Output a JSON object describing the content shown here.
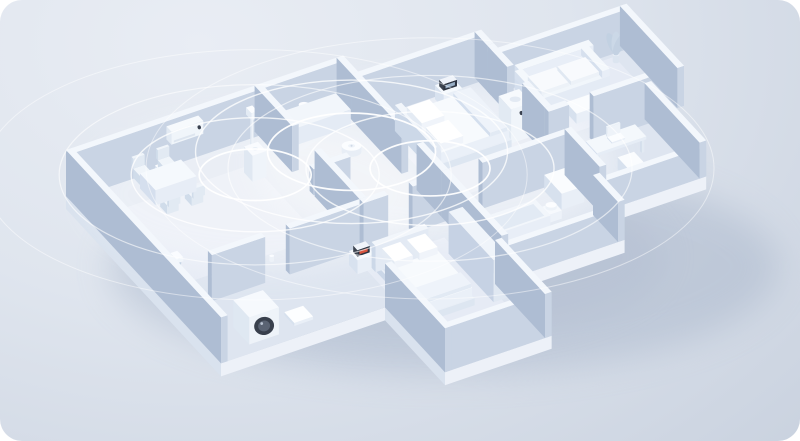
{
  "canvas": {
    "width": 800,
    "height": 441,
    "corner_radius": 22
  },
  "palette": {
    "background_top": "#e9edf4",
    "background_mid": "#dfe5ee",
    "background_bottom": "#c5cedc",
    "wall_top": "#f3f7fc",
    "wall_face_light": "#c9d4e4",
    "wall_face_dark": "#aebdd3",
    "floor": "#dee5f0",
    "slab_side_light": "#edf1f8",
    "slab_side_dark": "#d9e2ee",
    "rug": "#e9eef7",
    "object_top": "#fafcfe",
    "object_face_light": "#e9eff7",
    "object_face_dark": "#d7e1ee",
    "accent_dark": "#39404e",
    "signal_ring": "#ffffff",
    "shadow": "#9fadc4",
    "clock_display_red": "#e2563f",
    "clock_display_cool": "#9fb6cd"
  },
  "projection": {
    "origin": [
      66,
      196
    ],
    "u": [
      41,
      -14
    ],
    "v": [
      25,
      27
    ],
    "unit": 33
  },
  "floorplan": {
    "wall_height": 46,
    "wall_thickness": 0.16,
    "slab_drop": 13,
    "outline": [
      [
        0,
        0
      ],
      [
        6.6,
        0
      ],
      [
        6.6,
        0.6
      ],
      [
        9.6,
        0.6
      ],
      [
        9.6,
        1.1
      ],
      [
        13,
        1.1
      ],
      [
        13,
        3.4
      ],
      [
        12.2,
        3.4
      ],
      [
        12.2,
        5.6
      ],
      [
        9.6,
        5.6
      ],
      [
        9.6,
        6.6
      ],
      [
        6.6,
        6.6
      ],
      [
        6.6,
        8.6
      ],
      [
        4.0,
        8.6
      ],
      [
        4.0,
        6.2
      ],
      [
        0,
        6.2
      ]
    ],
    "walls": [
      {
        "f": [
          0,
          0
        ],
        "t": [
          6.6,
          0
        ]
      },
      {
        "f": [
          6.6,
          0
        ],
        "t": [
          6.6,
          0.6
        ]
      },
      {
        "f": [
          6.6,
          0.6
        ],
        "t": [
          9.6,
          0.6
        ]
      },
      {
        "f": [
          9.6,
          0.6
        ],
        "t": [
          9.6,
          1.1
        ]
      },
      {
        "f": [
          9.6,
          1.1
        ],
        "t": [
          13,
          1.1
        ],
        "h": 40
      },
      {
        "f": [
          12.84,
          1.1
        ],
        "t": [
          12.84,
          3.4
        ],
        "h": 40
      },
      {
        "f": [
          12.2,
          3.24
        ],
        "t": [
          13,
          3.24
        ],
        "h": 40
      },
      {
        "f": [
          12.04,
          3.4
        ],
        "t": [
          12.04,
          5.6
        ],
        "h": 36
      },
      {
        "f": [
          9.6,
          5.44
        ],
        "t": [
          12.2,
          5.44
        ],
        "h": 30
      },
      {
        "f": [
          9.44,
          5.6
        ],
        "t": [
          9.44,
          6.6
        ],
        "h": 40
      },
      {
        "f": [
          6.6,
          6.44
        ],
        "t": [
          9.6,
          6.44
        ],
        "h": 34
      },
      {
        "f": [
          6.44,
          6.6
        ],
        "t": [
          6.44,
          8.6
        ],
        "h": 44
      },
      {
        "f": [
          4.0,
          8.44
        ],
        "t": [
          6.6,
          8.44
        ],
        "h": 44
      },
      {
        "f": [
          4.0,
          6.2
        ],
        "t": [
          4.0,
          8.6
        ],
        "h": 44
      },
      {
        "f": [
          0,
          0
        ],
        "t": [
          0,
          6.2
        ]
      },
      {
        "f": [
          4.6,
          0
        ],
        "t": [
          4.6,
          1.5
        ]
      },
      {
        "f": [
          4.6,
          2.4
        ],
        "t": [
          4.6,
          4.2
        ]
      },
      {
        "f": [
          0.9,
          4.2
        ],
        "t": [
          2.2,
          4.2
        ]
      },
      {
        "f": [
          2.8,
          4.2
        ],
        "t": [
          4.6,
          4.2
        ]
      },
      {
        "f": [
          4.6,
          4.2
        ],
        "t": [
          5.2,
          4.2
        ]
      },
      {
        "f": [
          5.8,
          4.2
        ],
        "t": [
          6.6,
          4.2
        ]
      },
      {
        "f": [
          6.6,
          0.6
        ],
        "t": [
          6.6,
          2.6
        ]
      },
      {
        "f": [
          6.6,
          3.2
        ],
        "t": [
          6.6,
          4.2
        ]
      },
      {
        "f": [
          7.5,
          4.2
        ],
        "t": [
          9.6,
          4.2
        ]
      },
      {
        "f": [
          9.6,
          1.1
        ],
        "t": [
          9.6,
          1.9
        ]
      },
      {
        "f": [
          9.6,
          2.5
        ],
        "t": [
          9.6,
          3.4
        ]
      },
      {
        "f": [
          9.6,
          3.4
        ],
        "t": [
          10.1,
          3.4
        ]
      },
      {
        "f": [
          10.7,
          3.4
        ],
        "t": [
          12.2,
          3.4
        ]
      },
      {
        "f": [
          6.6,
          4.2
        ],
        "t": [
          6.6,
          6.6
        ]
      },
      {
        "f": [
          9.6,
          4.2
        ],
        "t": [
          9.6,
          5.6
        ]
      },
      {
        "f": [
          4.6,
          2.2
        ],
        "t": [
          5.5,
          2.2
        ],
        "h": 26
      }
    ],
    "rugs": [
      {
        "u": 0.9,
        "v": 0.9,
        "du": 3.1,
        "dv": 2.7
      },
      {
        "u": 7.0,
        "v": 1.1,
        "du": 2.3,
        "dv": 2.7
      },
      {
        "u": 9.95,
        "v": 1.35,
        "du": 2.6,
        "dv": 1.75
      },
      {
        "u": 4.3,
        "v": 4.8,
        "du": 2.0,
        "dv": 2.6
      }
    ],
    "floor_highlights": [
      {
        "at": [
          3.6,
          1.8
        ],
        "rx": 170,
        "ry": 75
      },
      {
        "at": [
          7.4,
          2.6
        ],
        "rx": 180,
        "ry": 80
      }
    ]
  },
  "furniture": [
    {
      "name": "dining-table-set",
      "type": "tableChairs",
      "u": 1.5,
      "v": 0.5,
      "du": 1.0,
      "dv": 0.62
    },
    {
      "name": "table-top-device",
      "type": "miniBox",
      "u": 1.78,
      "v": 0.64,
      "du": 0.32,
      "dv": 0.24,
      "z0": 15,
      "z1": 23,
      "top": "#fcfdff"
    },
    {
      "name": "wall-air-conditioner",
      "type": "wallAC",
      "u": 2.35,
      "v": 0.16,
      "du": 0.78,
      "dv": 0.2,
      "z0": 28,
      "z1": 41
    },
    {
      "name": "floor-lamp",
      "type": "lamp",
      "u": 4.28,
      "v": 0.4,
      "du": 0.1,
      "dv": 0.1
    },
    {
      "name": "smart-speaker-tower",
      "type": "tower",
      "u": 3.7,
      "v": 1.05,
      "s": 0.34,
      "h": 26
    },
    {
      "name": "motion-sensor",
      "type": "sensor",
      "u": 2.7,
      "v": 3.8,
      "du": 0.14,
      "dv": 0.14
    },
    {
      "name": "tv-console",
      "type": "miniBox",
      "u": 1.15,
      "v": 3.9,
      "du": 1.15,
      "dv": 0.24,
      "z0": 0,
      "z1": 9
    },
    {
      "name": "plant-living",
      "type": "plant",
      "u": 0.4,
      "v": 3.55,
      "du": 0.2,
      "dv": 0.2
    },
    {
      "name": "kitchen-counter",
      "type": "miniBox",
      "u": 4.82,
      "v": 0.18,
      "du": 1.65,
      "dv": 0.6,
      "z0": 0,
      "z1": 17,
      "top": "#f2f6fb",
      "se": "#e4ebf5",
      "sw": "#d3deed"
    },
    {
      "name": "kettle",
      "type": "cylinderDev",
      "u": 5.5,
      "v": 0.5,
      "r": 0.16,
      "z0": 17,
      "z1": 28
    },
    {
      "name": "cooking-pot",
      "type": "cylinderDev",
      "u": 5.95,
      "v": 0.45,
      "r": 0.13,
      "z0": 17,
      "z1": 24
    },
    {
      "name": "cooking-pot-small",
      "type": "cylinderDev",
      "u": 6.25,
      "v": 0.5,
      "r": 0.11,
      "z0": 17,
      "z1": 23
    },
    {
      "name": "robot-vacuum",
      "type": "disc",
      "u": 6.05,
      "v": 1.5,
      "r": 0.3
    },
    {
      "name": "master-bed",
      "type": "bed",
      "u": 7.25,
      "v": 1.35,
      "du": 1.85,
      "dv": 1.55,
      "head": "u"
    },
    {
      "name": "master-nightstand-clock",
      "type": "nightstand",
      "u": 8.5,
      "v": 0.82,
      "du": 0.45,
      "dv": 0.35,
      "display": "#9fb6cd"
    },
    {
      "name": "mesh-router-tower",
      "type": "tower",
      "u": 7.05,
      "v": 2.55,
      "s": 0.34,
      "h": 24
    },
    {
      "name": "air-purifier",
      "type": "purifier",
      "u": 9.15,
      "v": 2.3,
      "s": 0.5,
      "h": 34
    },
    {
      "name": "lounge-sofa",
      "type": "sofa",
      "u": 10.15,
      "v": 1.3,
      "du": 1.8,
      "dv": 0.85
    },
    {
      "name": "coffee-table",
      "type": "miniBox",
      "u": 10.7,
      "v": 2.45,
      "du": 0.6,
      "dv": 0.42,
      "z0": 0,
      "z1": 10
    },
    {
      "name": "plant-lounge",
      "type": "plant",
      "u": 12.5,
      "v": 1.5,
      "du": 0.2,
      "dv": 0.2
    },
    {
      "name": "study-desk-laptop",
      "type": "desk",
      "u": 10.3,
      "v": 3.9,
      "du": 1.2,
      "dv": 0.45
    },
    {
      "name": "desk-chair",
      "type": "miniBox",
      "u": 10.68,
      "v": 4.55,
      "du": 0.4,
      "dv": 0.4,
      "z0": 0,
      "z1": 12
    },
    {
      "name": "bathtub",
      "type": "tub",
      "u": 6.95,
      "v": 5.0,
      "du": 1.45,
      "dv": 0.6
    },
    {
      "name": "bathroom-sink",
      "type": "miniBox",
      "u": 8.95,
      "v": 4.45,
      "du": 0.55,
      "dv": 0.7,
      "z0": 0,
      "z1": 16
    },
    {
      "name": "toilet",
      "type": "toilet",
      "u": 8.5,
      "v": 5.1,
      "du": 0.3,
      "dv": 0.3
    },
    {
      "name": "bedroom2-bed",
      "type": "bed",
      "u": 4.45,
      "v": 5.0,
      "du": 1.25,
      "dv": 2.0,
      "head": "v"
    },
    {
      "name": "bedroom2-nightstand-clock",
      "type": "nightstand",
      "u": 4.06,
      "v": 4.66,
      "du": 0.42,
      "dv": 0.34,
      "display": "#e2563f"
    },
    {
      "name": "wardrobe",
      "type": "miniBox",
      "u": 6.1,
      "v": 5.3,
      "du": 0.34,
      "dv": 1.8,
      "z0": 0,
      "z1": 42,
      "top": "#eff4fa",
      "se": "#e0e8f2",
      "sw": "#c6d2e4"
    },
    {
      "name": "tv-panel",
      "type": "wallPanel",
      "u": 6.6,
      "v1": 5.1,
      "v2": 6.4,
      "z0": 12,
      "z1": 32
    },
    {
      "name": "washing-machine",
      "type": "washer",
      "u": 0.85,
      "v": 5.3,
      "du": 0.72,
      "dv": 0.64,
      "h": 27
    },
    {
      "name": "smart-scale",
      "type": "miniBox",
      "u": 2.0,
      "v": 5.45,
      "du": 0.46,
      "dv": 0.4,
      "z0": 0,
      "z1": 3,
      "top": "#fdfeff"
    },
    {
      "name": "self-balancing-scooter",
      "type": "scooter",
      "u": 0.28,
      "v": 3.45,
      "du": 0.3,
      "dv": 0.65
    }
  ],
  "signal_rings": [
    {
      "name": "signal-rings-living-speaker",
      "center": [
        3.87,
        1.22
      ],
      "radii": [
        56,
        124,
        196,
        272
      ]
    },
    {
      "name": "signal-rings-robot-vacuum",
      "center": [
        6.05,
        1.5
      ],
      "radii": [
        84,
        156
      ]
    },
    {
      "name": "signal-rings-bedroom-router",
      "center": [
        7.22,
        2.72
      ],
      "radii": [
        60,
        124,
        202,
        284
      ]
    }
  ],
  "ring_style": {
    "ry_factor": 0.46,
    "widths": [
      1.7,
      1.4,
      1.2,
      1.0
    ],
    "opacities": [
      0.95,
      0.78,
      0.6,
      0.48
    ]
  }
}
